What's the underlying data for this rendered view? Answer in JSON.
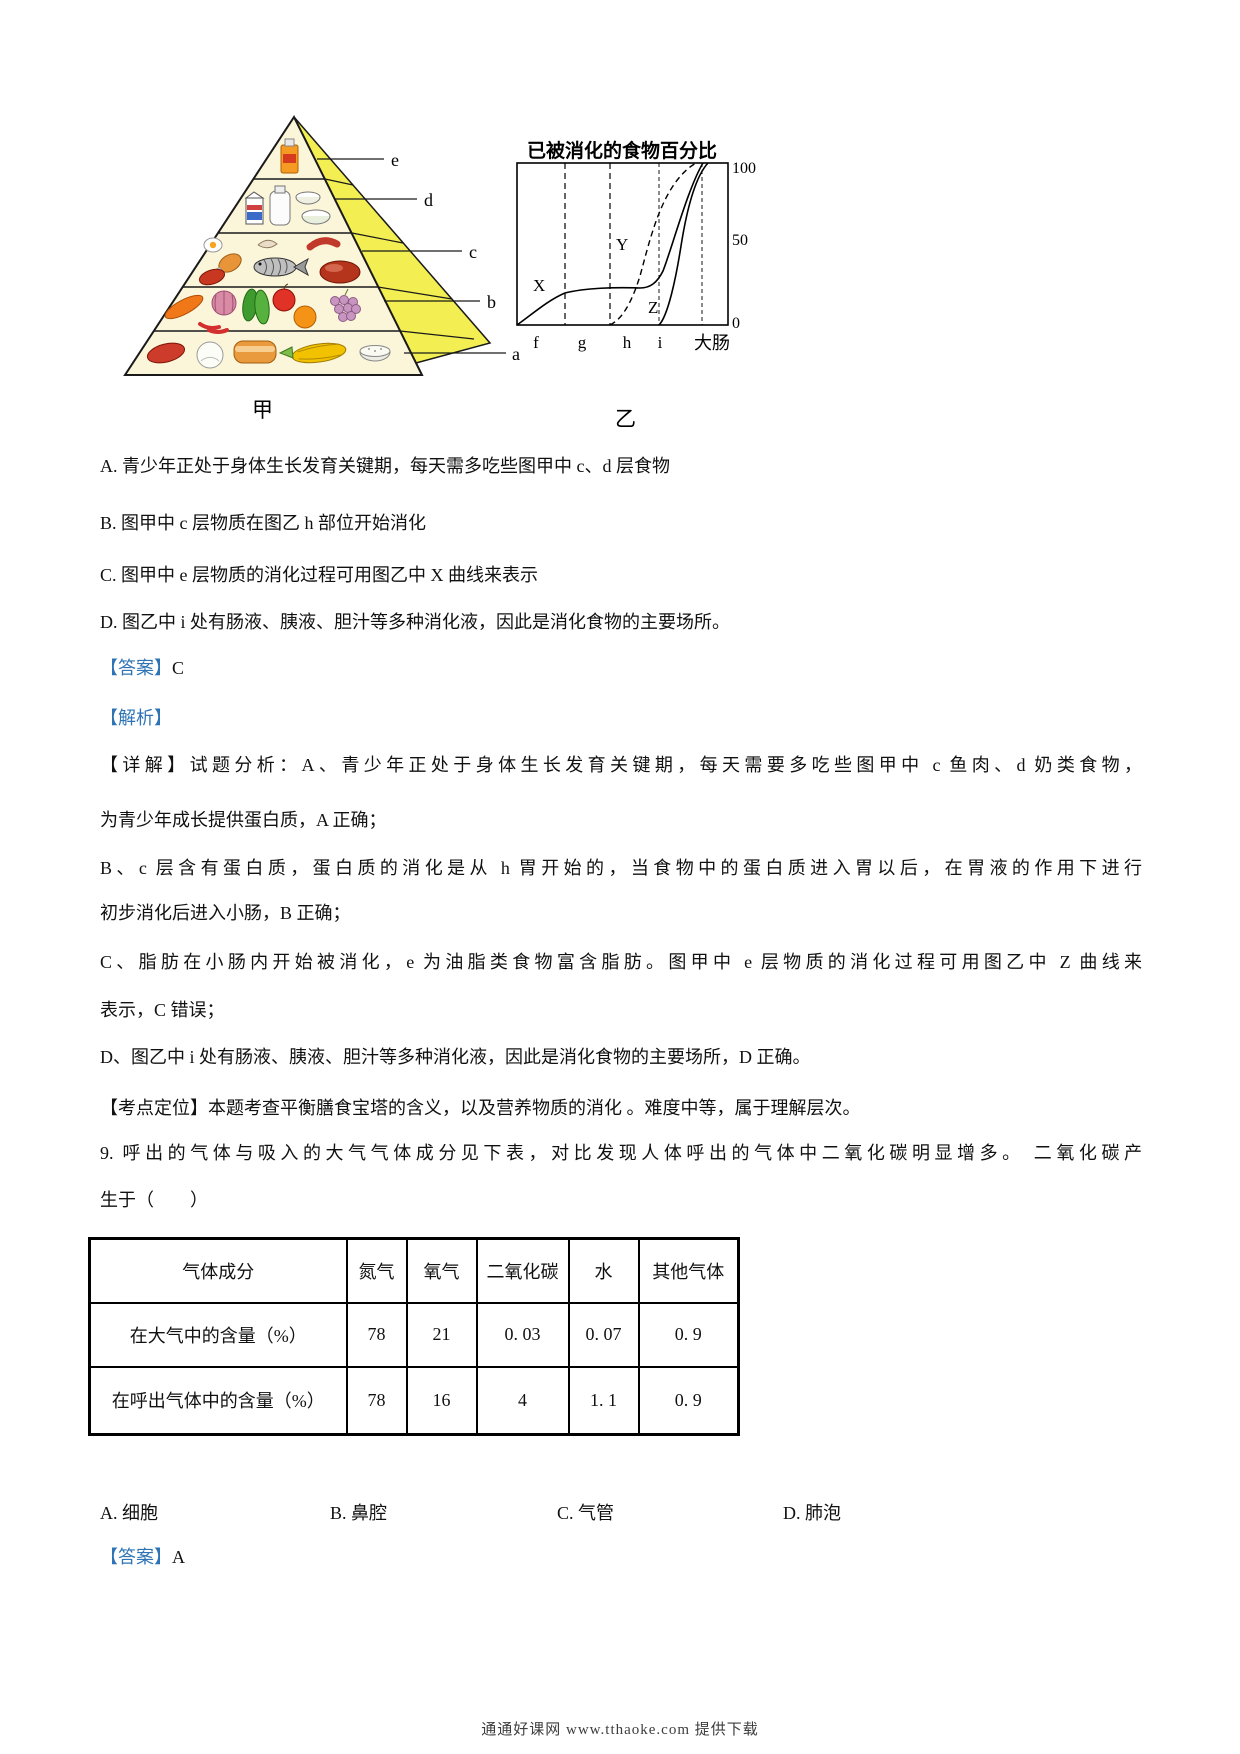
{
  "figure": {
    "pyramid": {
      "caption": "甲",
      "layer_labels": [
        "e",
        "d",
        "c",
        "b",
        "a"
      ],
      "food_icons": {
        "e": [
          "cooking-oil-bottle-icon"
        ],
        "d": [
          "milk-carton-icon",
          "milk-bottle-icon",
          "bowl-icon",
          "bowl-icon"
        ],
        "c": [
          "egg-icon",
          "chicken-leg-icon",
          "meat-icon",
          "shrimp-icon",
          "fish-icon",
          "sausage-icon",
          "roast-meat-icon"
        ],
        "b": [
          "carrot-icon",
          "chili-icon",
          "onion-icon",
          "leafy-greens-icon",
          "apple-icon",
          "orange-icon",
          "grapes-icon"
        ],
        "a": [
          "sweet-potato-icon",
          "steamed-bun-icon",
          "bread-icon",
          "corn-icon",
          "rice-bowl-icon"
        ]
      }
    },
    "chart": {
      "caption": "乙",
      "title": "已被消化的食物百分比",
      "y_ticks": [
        "100",
        "50",
        "0"
      ],
      "x_labels": [
        "f",
        "g",
        "h",
        "i",
        "大肠"
      ],
      "curve_labels": [
        "X",
        "Y",
        "Z"
      ]
    }
  },
  "chart_data": {
    "type": "line",
    "title": "已被消化的食物百分比",
    "x_categories": [
      "f",
      "g",
      "h",
      "i",
      "大肠"
    ],
    "x_boundaries_pct": [
      23,
      44,
      67,
      88
    ],
    "ylim": [
      0,
      100
    ],
    "y_ticks": [
      0,
      50,
      100
    ],
    "grid": false,
    "series": [
      {
        "name": "X",
        "style": "solid",
        "points_pct_x_y": [
          [
            0,
            0
          ],
          [
            12,
            10
          ],
          [
            23,
            19
          ],
          [
            35,
            21
          ],
          [
            50,
            20
          ],
          [
            62,
            21
          ],
          [
            70,
            28
          ],
          [
            78,
            58
          ],
          [
            88,
            100
          ]
        ]
      },
      {
        "name": "Y",
        "style": "dashed",
        "points_pct_x_y": [
          [
            44,
            0
          ],
          [
            52,
            8
          ],
          [
            60,
            28
          ],
          [
            67,
            48
          ],
          [
            74,
            78
          ],
          [
            85,
            100
          ]
        ]
      },
      {
        "name": "Z",
        "style": "solid",
        "points_pct_x_y": [
          [
            67,
            0
          ],
          [
            73,
            12
          ],
          [
            78,
            38
          ],
          [
            83,
            65
          ],
          [
            91,
            100
          ]
        ]
      }
    ]
  },
  "q8": {
    "options": [
      "A. 青少年正处于身体生长发育关键期，每天需多吃些图甲中 c、d 层食物",
      "B. 图甲中 c 层物质在图乙 h 部位开始消化",
      "C. 图甲中 e 层物质的消化过程可用图乙中 X 曲线来表示",
      "D. 图乙中 i 处有肠液、胰液、胆汁等多种消化液，因此是消化食物的主要场所。"
    ],
    "answer_label": "【答案】",
    "answer": "C",
    "analysis_label": "【解析】",
    "detail_lines": [
      "【详解】试题分析：A、青少年正处于身体生长发育关键期，每天需要多吃些图甲中 c 鱼肉、d 奶类食物，",
      "为青少年成长提供蛋白质，A 正确；",
      "B、c 层含有蛋白质，蛋白质的消化是从 h 胃开始的，当食物中的蛋白质进入胃以后，在胃液的作用下进行",
      "初步消化后进入小肠，B 正确；",
      "C、脂肪在小肠内开始被消化，e 为油脂类食物富含脂肪。图甲中 e 层物质的消化过程可用图乙中 Z 曲线来",
      "表示，C 错误；",
      "D、图乙中 i 处有肠液、胰液、胆汁等多种消化液，因此是消化食物的主要场所，D 正确。"
    ],
    "kaodian_line": "【考点定位】本题考查平衡膳食宝塔的含义，以及营养物质的消化 。难度中等，属于理解层次。"
  },
  "q9": {
    "stem_line1": "9. 呼出的气体与吸入的大气气体成分见下表，对比发现人体呼出的气体中二氧化碳明显增多。 二氧化碳产",
    "stem_line2": "生于（　　）",
    "table": {
      "headers": [
        "气体成分",
        "氮气",
        "氧气",
        "二氧化碳",
        "水",
        "其他气体"
      ],
      "rows": [
        [
          "在大气中的含量（%）",
          "78",
          "21",
          "0. 03",
          "0. 07",
          "0. 9"
        ],
        [
          "在呼出气体中的含量（%）",
          "78",
          "16",
          "4",
          "1. 1",
          "0. 9"
        ]
      ]
    },
    "options": [
      "A. 细胞",
      "B. 鼻腔",
      "C. 气管",
      "D. 肺泡"
    ],
    "answer_label": "【答案】",
    "answer": "A"
  },
  "footer_text": "通通好课网  www.tthaoke.com  提供下载",
  "colors": {
    "label_blue": "#2E74B5",
    "pyramid_band_yellow": "#F3EF52",
    "pyramid_face_cream": "#FBF5DA"
  }
}
